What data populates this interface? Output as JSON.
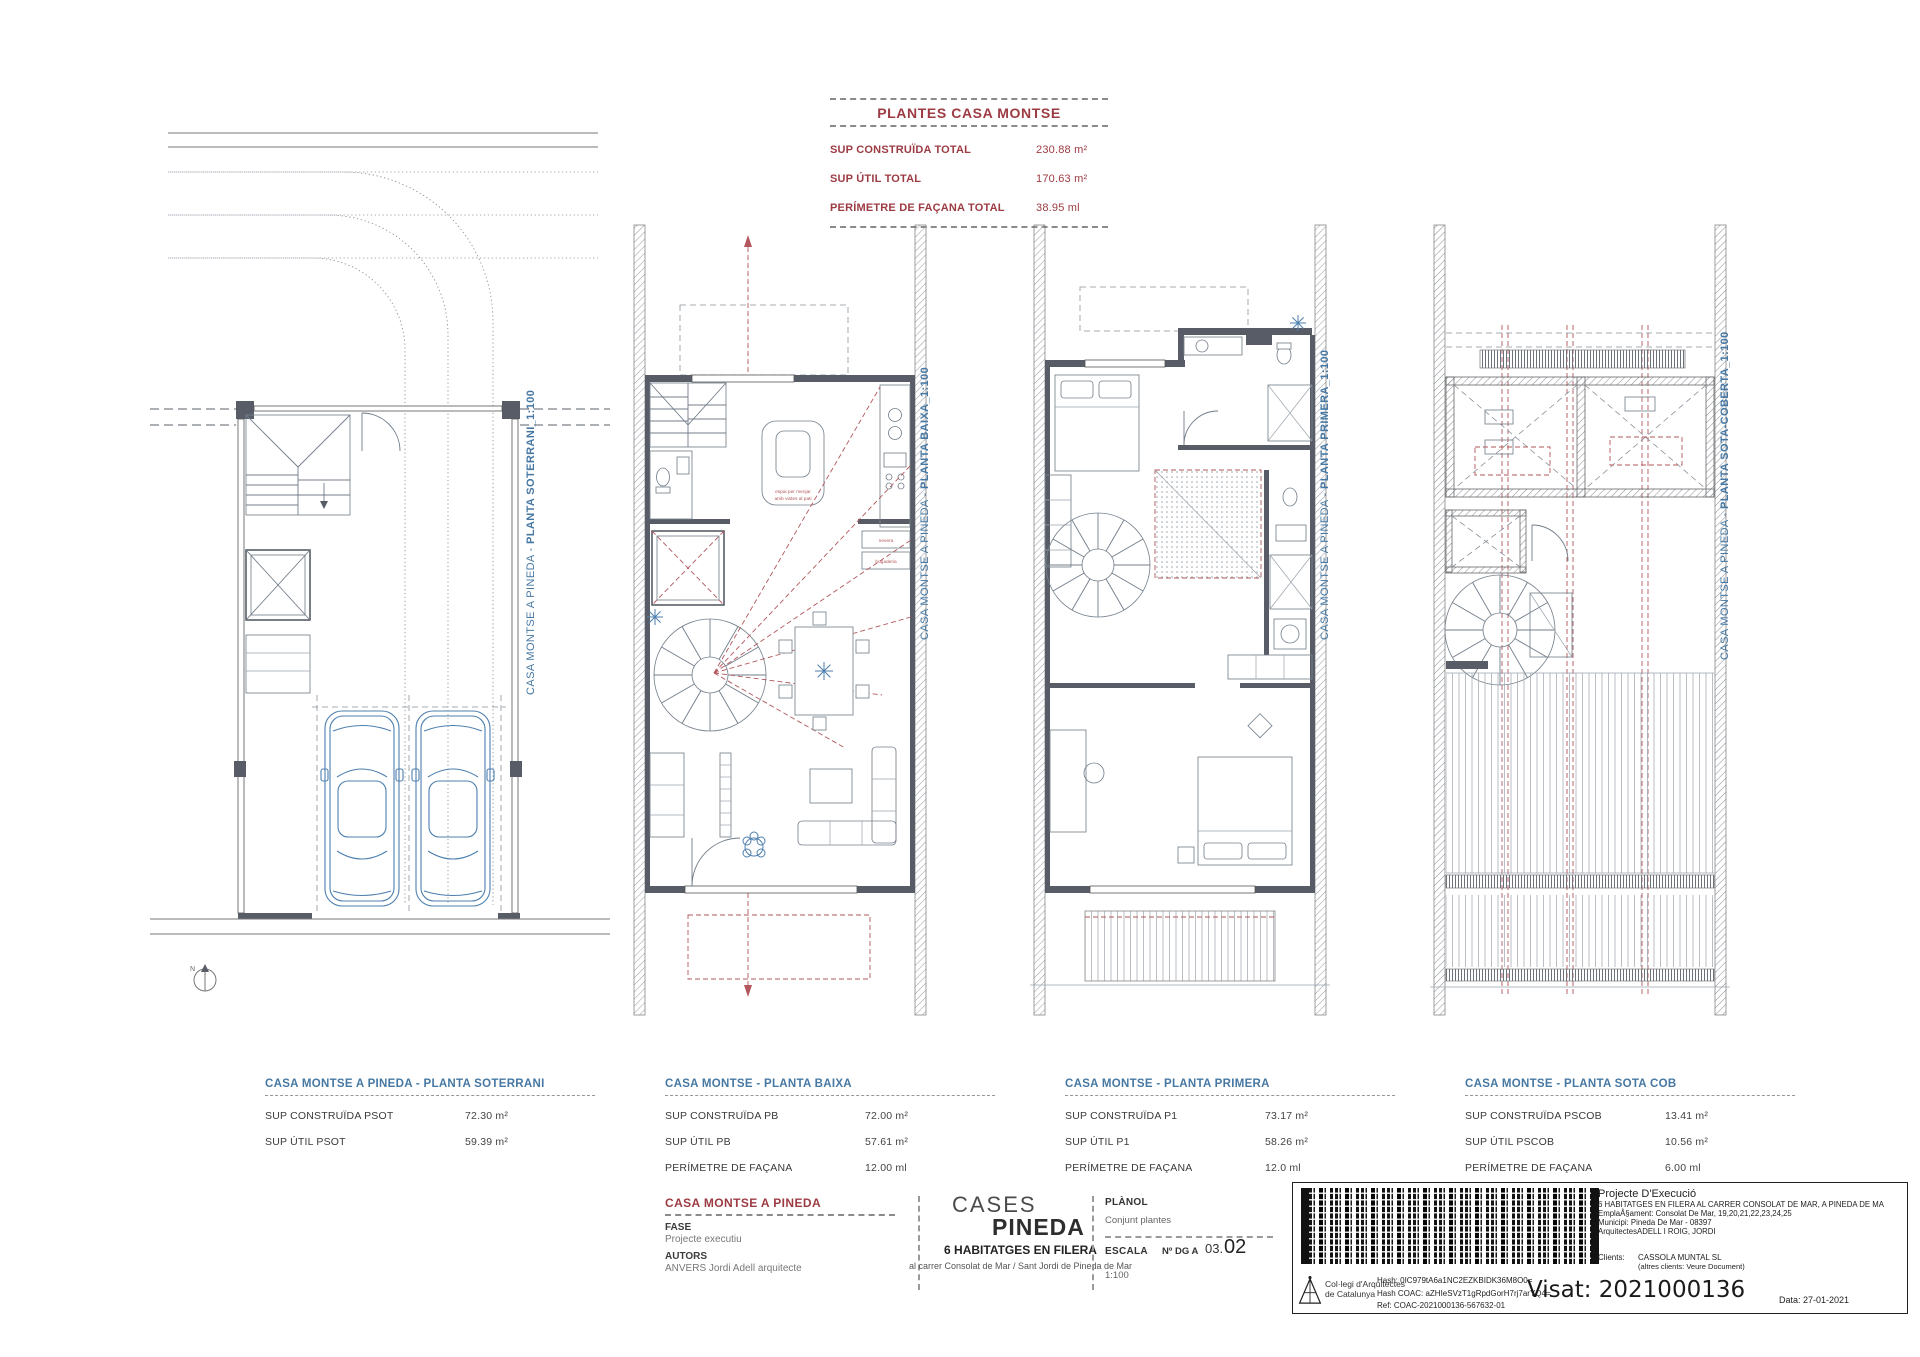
{
  "colors": {
    "accent_red": "#9d3b43",
    "accent_blue": "#4678a3",
    "plan_wall": "#575c66",
    "plan_line": "#707c89",
    "dash_red": "#b2575b",
    "car_blue": "#4d7fae"
  },
  "summary_block": {
    "title": "PLANTES CASA MONTSE",
    "rows": [
      {
        "label": "SUP CONSTRUÏDA TOTAL",
        "value": "230.88 m²"
      },
      {
        "label": "SUP ÚTIL TOTAL",
        "value": "170.63 m²"
      },
      {
        "label": "PERÍMETRE DE FAÇANA TOTAL",
        "value": "38.95 ml"
      }
    ]
  },
  "plan_labels": [
    {
      "prefix": "CASA MONTSE A PINEDA - ",
      "title": "PLANTA SOTERRANI_1:100"
    },
    {
      "prefix": "CASA MONTSE A PINEDA - ",
      "title": "PLANTA BAIXA_1:100"
    },
    {
      "prefix": "CASA MONTSE A PINEDA - ",
      "title": "PLANTA PRIMERA_1:100"
    },
    {
      "prefix": "CASA MONTSE A PINEDA - ",
      "title": "PLANTA SOTA-COBERTA_1:100"
    }
  ],
  "plan_texts": {
    "dining_line1": "espai per menjar",
    "dining_line2": "amb vistes al pati",
    "fridge": "nevera",
    "laundry": "bugaderia",
    "north": "N"
  },
  "area_tables": [
    {
      "header": "CASA MONTSE A PINEDA - PLANTA SOTERRANI",
      "rows": [
        {
          "label": "SUP CONSTRUÏDA PSOT",
          "value": "72.30 m²"
        },
        {
          "label": "SUP ÚTIL PSOT",
          "value": "59.39 m²"
        }
      ]
    },
    {
      "header": "CASA MONTSE - PLANTA BAIXA",
      "rows": [
        {
          "label": "SUP CONSTRUÏDA PB",
          "value": "72.00 m²"
        },
        {
          "label": "SUP ÚTIL PB",
          "value": "57.61 m²"
        },
        {
          "label": "PERÍMETRE DE FAÇANA",
          "value": "12.00 ml"
        }
      ]
    },
    {
      "header": "CASA MONTSE - PLANTA PRIMERA",
      "rows": [
        {
          "label": "SUP CONSTRUÏDA P1",
          "value": "73.17 m²"
        },
        {
          "label": "SUP ÚTIL P1",
          "value": "58.26 m²"
        },
        {
          "label": "PERÍMETRE DE FAÇANA",
          "value": "12.0 ml"
        }
      ]
    },
    {
      "header": "CASA MONTSE - PLANTA SOTA COB",
      "rows": [
        {
          "label": "SUP CONSTRUÏDA PSCOB",
          "value": "13.41 m²"
        },
        {
          "label": "SUP ÚTIL PSCOB",
          "value": "10.56 m²"
        },
        {
          "label": "PERÍMETRE DE FAÇANA",
          "value": "6.00 ml"
        }
      ]
    }
  ],
  "footer": {
    "project": {
      "title": "CASA MONTSE A PINEDA",
      "fase_label": "FASE",
      "fase_value": "Projecte executiu",
      "autors_label": "AUTORS",
      "autors_value": "ANVERS  Jordi Adell arquitecte"
    },
    "cases": {
      "line1": "CASES",
      "line2": "PINEDA",
      "subtitle": "6 HABITATGES EN FILERA",
      "address": "al carrer Consolat de Mar / Sant Jordi de Pineda de Mar"
    },
    "planol": {
      "label": "PLÀNOL",
      "value": "Conjunt plantes",
      "escala_label": "ESCALA",
      "escala_value": "1:100",
      "num_label": "Nº DG A",
      "num_small": "03.",
      "num_big": "02"
    }
  },
  "stamp": {
    "org_line1": "Col·legi d'Arquitectes",
    "org_line2": "de Catalunya",
    "hash1": "Hash: 0IC979tA6a1NC2EZKBIDK36M8O0=",
    "hash2": "Hash COAC: aZHIeSVzT1gRpdGorH7rj7arYQ4=",
    "ref": "Ref: COAC-2021000136-567632-01",
    "project_title": "Projecte D'Execució",
    "project_lines": [
      "6 HABITATGES EN FILERA AL CARRER CONSOLAT DE MAR, A PINEDA DE MA",
      "EmplaÅ§ament: Consolat De Mar, 19,20,21,22,23,24,25",
      "Municipi: Pineda De Mar - 08397",
      "ArquitectesADELL I ROIG, JORDI"
    ],
    "clients_label": "Clients:",
    "clients_value": "CASSOLA MUNTAL SL",
    "clients_note": "(altres clients: Veure Document)",
    "visat": "Visat: 2021000136",
    "date": "Data: 27-01-2021"
  }
}
